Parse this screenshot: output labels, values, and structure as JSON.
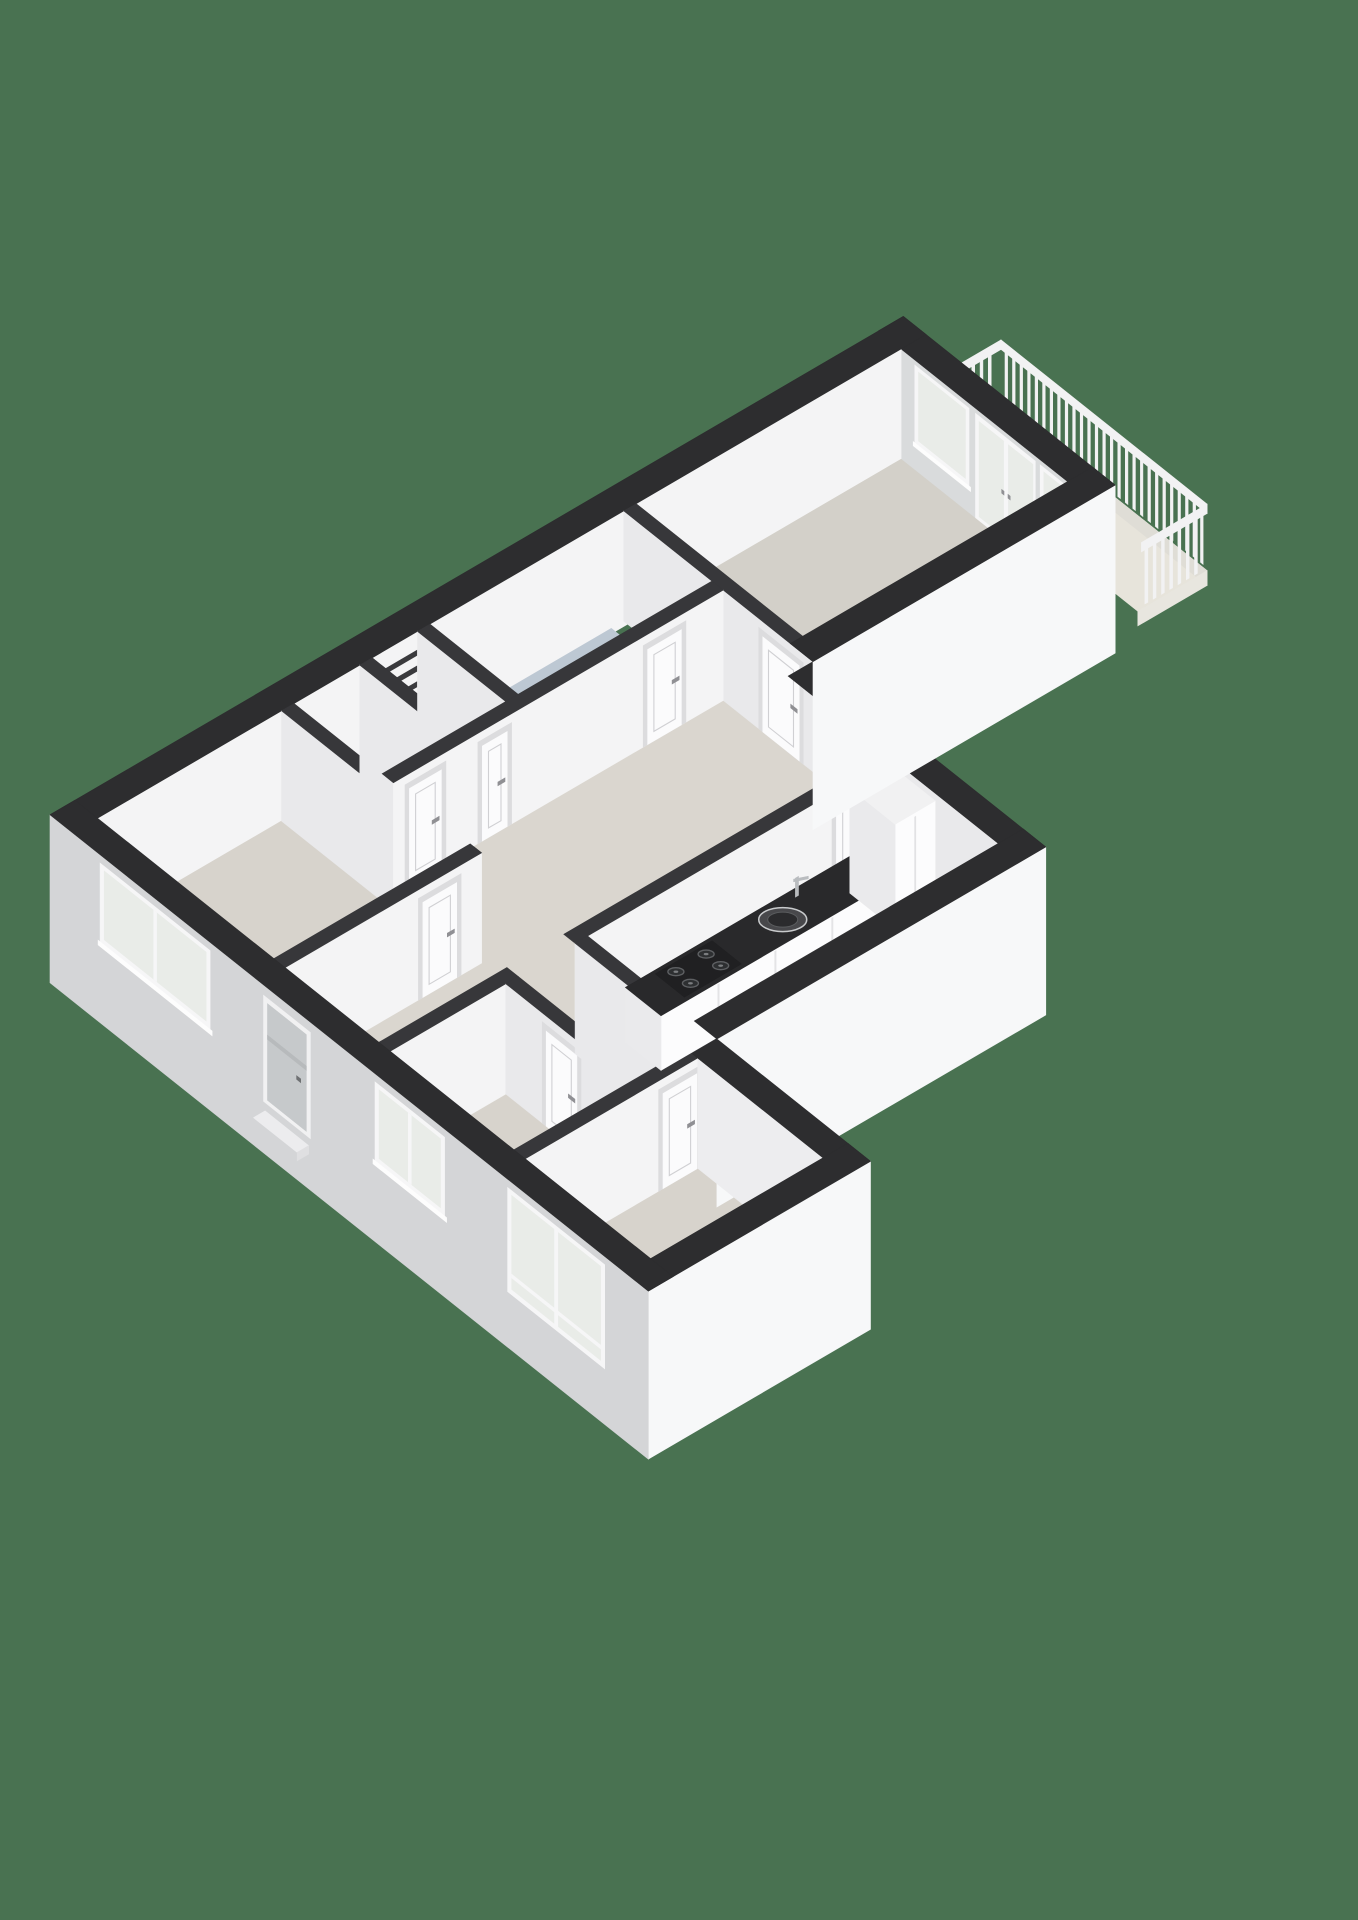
{
  "view": {
    "type": "3d-floorplan-render",
    "projection": "isometric",
    "width": 1358,
    "height": 1920
  },
  "scene": {
    "rooms": [
      {
        "id": "living-room"
      },
      {
        "id": "kitchen"
      },
      {
        "id": "hall"
      },
      {
        "id": "corridor"
      },
      {
        "id": "bathroom"
      },
      {
        "id": "toilet"
      },
      {
        "id": "storage-closet"
      },
      {
        "id": "bedroom-1"
      },
      {
        "id": "bedroom-2"
      },
      {
        "id": "bedroom-3"
      },
      {
        "id": "balcony"
      }
    ],
    "features": [
      {
        "id": "balcony-railing"
      },
      {
        "id": "french-doors"
      },
      {
        "id": "living-room-windows"
      },
      {
        "id": "front-door"
      },
      {
        "id": "facade-windows"
      },
      {
        "id": "kitchen-counter"
      },
      {
        "id": "kitchen-sink"
      },
      {
        "id": "gas-hob"
      },
      {
        "id": "tall-cabinet"
      },
      {
        "id": "wall-basin"
      },
      {
        "id": "meter-cupboard"
      },
      {
        "id": "shower-tray"
      },
      {
        "id": "interior-doors"
      }
    ]
  },
  "colors": {
    "background": "#497251",
    "band": "#2d2d2f",
    "band_in": "#37373a",
    "facade_left": "#d4d5d7",
    "facade_white": "#f7f8f9",
    "wall_bright": "#f4f4f5",
    "wall_side": "#e9e9eb",
    "wall_right_in": "#d9dbdc",
    "wall_step": "#ededef",
    "floor_living": "#d3d0c9",
    "floor_bed": "#d7d3cc",
    "floor_hall": "#dad6cf",
    "floor_bath": "#bdc8d3",
    "floor_kitchen": "#b6c2ce",
    "floor_toilet": "#c3ced7",
    "floor_balcony": "#e7e4db",
    "balcony_edge": "#dfddd6",
    "glass": "#e9ece8",
    "win_frame": "#f6f6f7",
    "sill": "#fdfdfd",
    "door_frame": "#dcdcde",
    "door_leaf": "#fbfbfc",
    "door_line": "#d0d0d3",
    "door_gray": "#c6c9cb",
    "handle": "#909094",
    "counter": "#29292b",
    "cabinet": "#fcfcfd",
    "cabinet_side": "#eaeaec",
    "steel": "#b9bcbf",
    "hob": "#202022",
    "burner": "#2d2f31",
    "burner_ring": "#5e6063",
    "rail": "#f2f2f3",
    "slat": "#3a3a3d",
    "shower": "#cfd8e0",
    "boiler": "#fafafa",
    "shadow": "rgba(0,0,0,0.16)"
  }
}
